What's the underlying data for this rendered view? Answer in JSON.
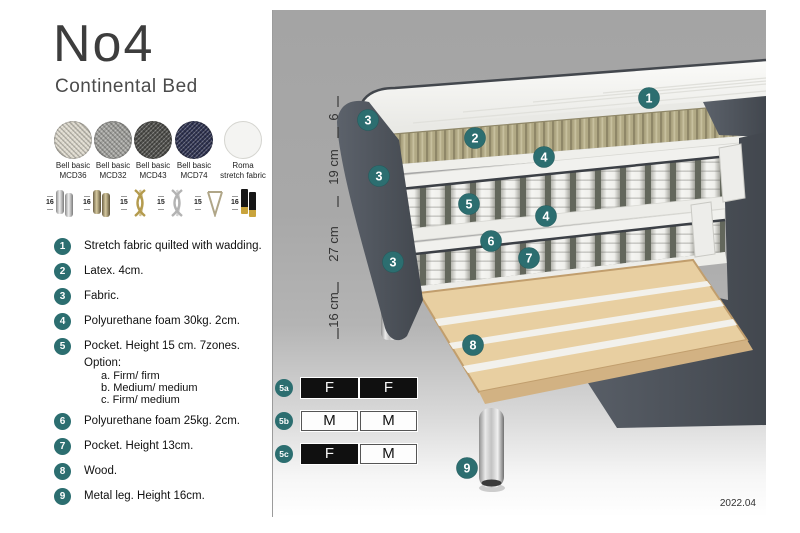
{
  "header": {
    "title": "No4",
    "subtitle": "Continental Bed"
  },
  "fabrics": {
    "items": [
      {
        "line1": "Bell basic",
        "line2": "MCD36",
        "color": "#dcd8cc"
      },
      {
        "line1": "Bell basic",
        "line2": "MCD32",
        "color": "#a3a39f"
      },
      {
        "line1": "Bell basic",
        "line2": "MCD43",
        "color": "#4d4d49"
      },
      {
        "line1": "Bell basic",
        "line2": "MCD74",
        "color": "#2e3250"
      },
      {
        "line1": "Roma",
        "line2": "stretch fabric",
        "color": "#f4f4f2"
      }
    ]
  },
  "legs": {
    "items": [
      {
        "height": "16",
        "type": "cylinder-silver"
      },
      {
        "height": "16",
        "type": "cylinder-bronze"
      },
      {
        "height": "15",
        "type": "twisted-gold"
      },
      {
        "height": "15",
        "type": "twisted-silver"
      },
      {
        "height": "15",
        "type": "hairpin"
      },
      {
        "height": "16",
        "type": "black-gold-tip"
      }
    ]
  },
  "features": {
    "items": [
      {
        "num": "1",
        "text": "Stretch fabric quilted with wadding."
      },
      {
        "num": "2",
        "text": "Latex. 4cm."
      },
      {
        "num": "3",
        "text": "Fabric."
      },
      {
        "num": "4",
        "text": "Polyurethane foam 30kg. 2cm."
      },
      {
        "num": "5",
        "text": "Pocket. Height 15 cm. 7zones. Option:",
        "optionA": "a. Firm/ firm",
        "optionB": "b. Medium/ medium",
        "optionC": "c. Firm/ medium"
      },
      {
        "num": "6",
        "text": "Polyurethane foam 25kg. 2cm."
      },
      {
        "num": "7",
        "text": "Pocket. Height 13cm."
      },
      {
        "num": "8",
        "text": "Wood."
      },
      {
        "num": "9",
        "text": "Metal leg. Height 16cm."
      }
    ]
  },
  "diagram": {
    "dimensions": [
      "6",
      "19 cm",
      "27 cm",
      "16 cm"
    ],
    "callouts": {
      "c1": "1",
      "c2": "2",
      "c3a": "3",
      "c3b": "3",
      "c3c": "3",
      "c4a": "4",
      "c4b": "4",
      "c5": "5",
      "c6": "6",
      "c7": "7",
      "c8": "8",
      "c9": "9"
    },
    "firmness": [
      {
        "label": "5a",
        "left": "F",
        "right": "F"
      },
      {
        "label": "5b",
        "left": "M",
        "right": "M"
      },
      {
        "label": "5c",
        "left": "F",
        "right": "M"
      }
    ],
    "version": "2022.04"
  },
  "colors": {
    "accent_teal": "#2c6e70",
    "panel_gray": "#a8a8a8",
    "fabric_dark": "#535961",
    "latex_tan": "#b1a985",
    "wood": "#e8cfa1"
  }
}
